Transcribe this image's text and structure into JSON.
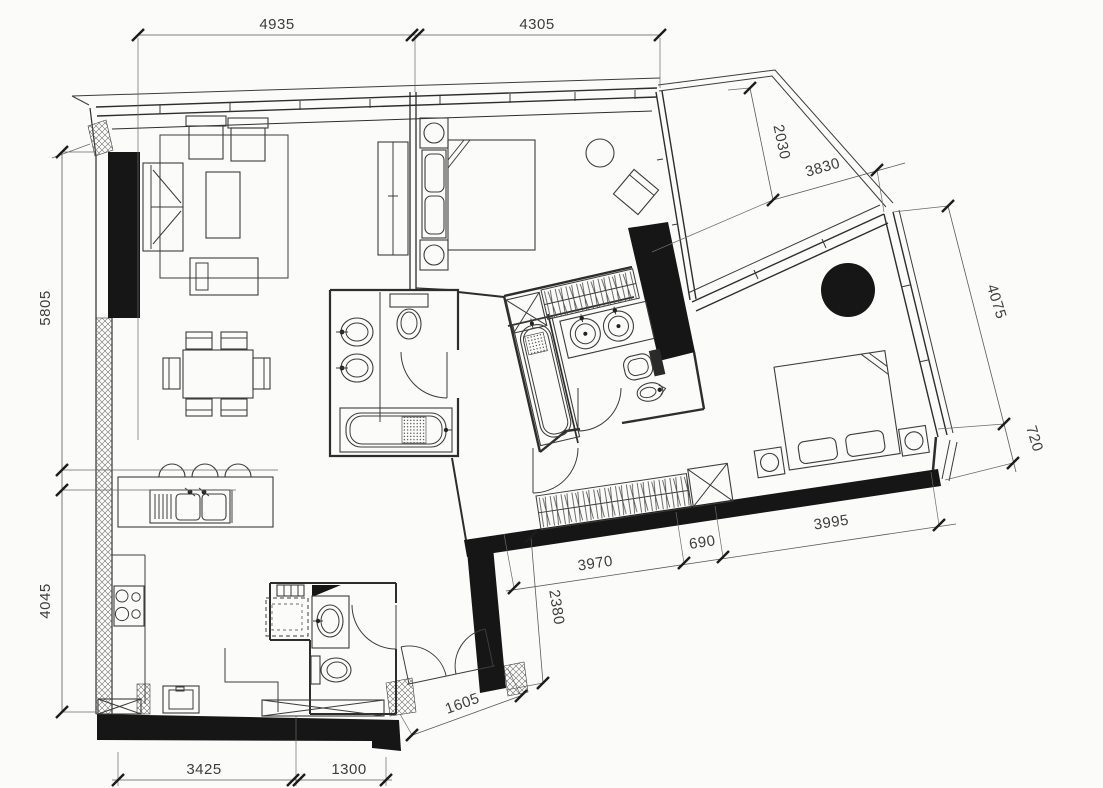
{
  "drawing": {
    "kind": "apartment floor plan",
    "dims": {
      "d4935": "4935",
      "d4305": "4305",
      "d5805": "5805",
      "d4045": "4045",
      "d3425": "3425",
      "d1300": "1300",
      "d1605": "1605",
      "d2030": "2030",
      "d3830": "3830",
      "d4075": "4075",
      "d720": "720",
      "d3970": "3970",
      "d690": "690",
      "d3995": "3995",
      "d2380": "2380"
    }
  }
}
